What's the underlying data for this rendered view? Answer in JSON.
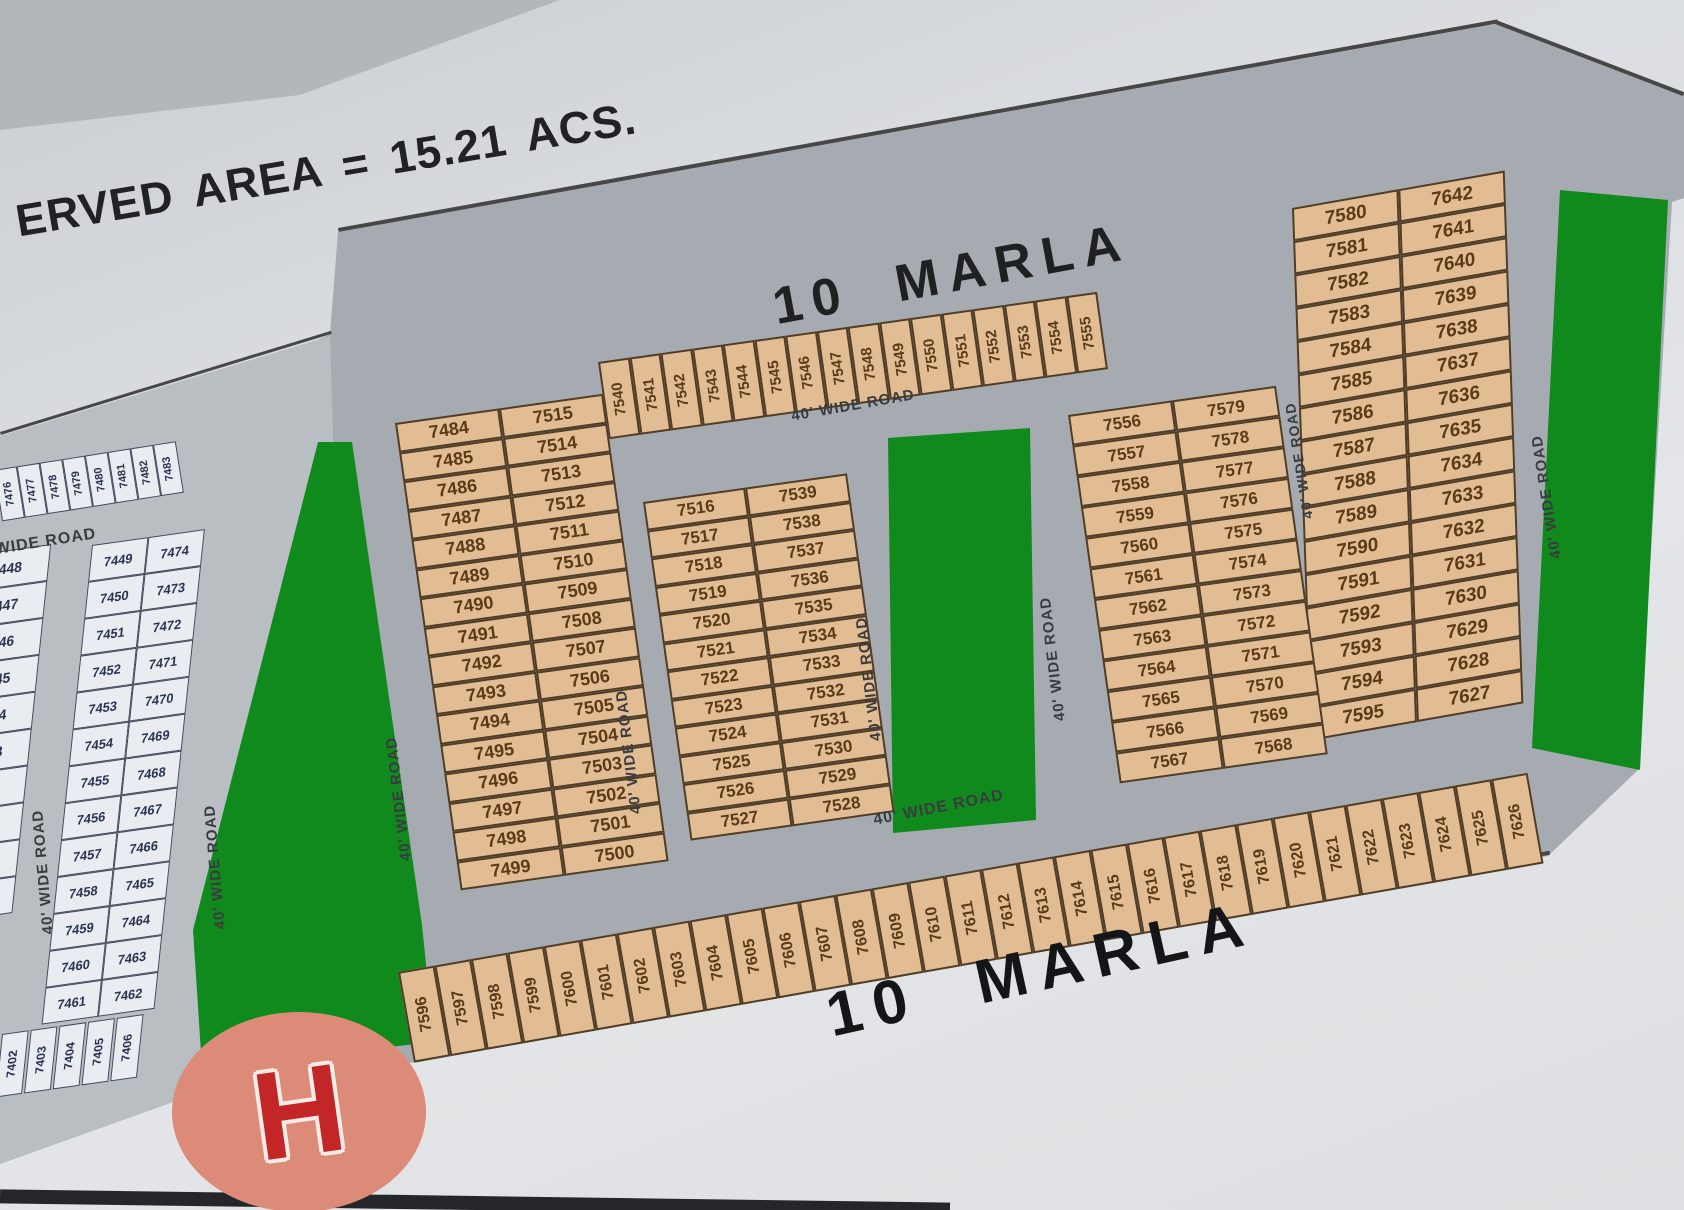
{
  "reserved_area_text": "ERVED AREA = 15.21 ACS.",
  "marla_top": "10 MARLA",
  "marla_bottom": "10 MARLA",
  "road_label": "40' WIDE ROAD",
  "hospital_letter": "H",
  "colors": {
    "plot_tan": "#e2bd94",
    "plot_white": "#e9ecf1",
    "road_gray": "#a6abb1",
    "green_area": "#108a1d",
    "hospital_red": "#c32626",
    "hospital_circle": "#db8b77"
  },
  "plots": {
    "top_row": [
      "7540",
      "7541",
      "7542",
      "7543",
      "7544",
      "7545",
      "7546",
      "7547",
      "7548",
      "7549",
      "7550",
      "7551",
      "7552",
      "7553",
      "7554",
      "7555"
    ],
    "right_block_left": [
      "7580",
      "7581",
      "7582",
      "7583",
      "7584",
      "7585",
      "7586",
      "7587",
      "7588",
      "7589",
      "7590",
      "7591",
      "7592",
      "7593",
      "7594",
      "7595"
    ],
    "right_block_right": [
      "7642",
      "7641",
      "7640",
      "7639",
      "7638",
      "7637",
      "7636",
      "7635",
      "7634",
      "7633",
      "7632",
      "7631",
      "7630",
      "7629",
      "7628",
      "7627"
    ],
    "block_a_left": [
      "7484",
      "7485",
      "7486",
      "7487",
      "7488",
      "7489",
      "7490",
      "7491",
      "7492",
      "7493",
      "7494",
      "7495",
      "7496",
      "7497",
      "7498",
      "7499"
    ],
    "block_a_right": [
      "7515",
      "7514",
      "7513",
      "7512",
      "7511",
      "7510",
      "7509",
      "7508",
      "7507",
      "7506",
      "7505",
      "7504",
      "7503",
      "7502",
      "7501",
      "7500"
    ],
    "block_b_left": [
      "7516",
      "7517",
      "7518",
      "7519",
      "7520",
      "7521",
      "7522",
      "7523",
      "7524",
      "7525",
      "7526",
      "7527"
    ],
    "block_b_right": [
      "7539",
      "7538",
      "7537",
      "7536",
      "7535",
      "7534",
      "7533",
      "7532",
      "7531",
      "7530",
      "7529",
      "7528"
    ],
    "block_c_left": [
      "7556",
      "7557",
      "7558",
      "7559",
      "7560",
      "7561",
      "7562",
      "7563",
      "7564",
      "7565",
      "7566",
      "7567"
    ],
    "block_c_right": [
      "7579",
      "7578",
      "7577",
      "7576",
      "7575",
      "7574",
      "7573",
      "7572",
      "7571",
      "7570",
      "7569",
      "7568"
    ],
    "bottom_row": [
      "7596",
      "7597",
      "7598",
      "7599",
      "7600",
      "7601",
      "7602",
      "7603",
      "7604",
      "7605",
      "7606",
      "7607",
      "7608",
      "7609",
      "7610",
      "7611",
      "7612",
      "7613",
      "7614",
      "7615",
      "7616",
      "7617",
      "7618",
      "7619",
      "7620",
      "7621",
      "7622",
      "7623",
      "7624",
      "7625",
      "7626"
    ],
    "left_top_row": [
      "7476",
      "7477",
      "7478",
      "7479",
      "7480",
      "7481",
      "7482",
      "7483"
    ],
    "left_col": [
      "7448",
      "7447",
      "7446",
      "7445",
      "7444",
      "7443",
      "7442",
      "7441",
      "7440",
      "7439"
    ],
    "left_pair_left": [
      "7449",
      "7450",
      "7451",
      "7452",
      "7453",
      "7454",
      "7455",
      "7456",
      "7457",
      "7458",
      "7459",
      "7460",
      "7461"
    ],
    "left_pair_right": [
      "7474",
      "7473",
      "7472",
      "7471",
      "7470",
      "7469",
      "7468",
      "7467",
      "7466",
      "7465",
      "7464",
      "7463",
      "7462"
    ],
    "left_bottom_row": [
      "7402",
      "7403",
      "7404",
      "7405",
      "7406"
    ]
  }
}
